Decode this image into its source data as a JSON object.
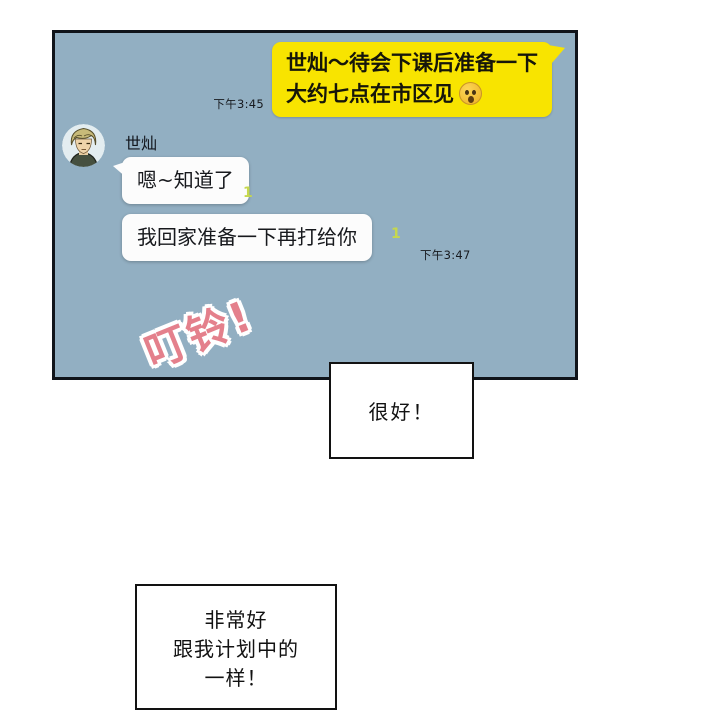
{
  "panel": {
    "outgoing_message": {
      "line1": "世灿～待会下课后准备一下",
      "line2": "大约七点在市区见",
      "emoji": "surprised-face",
      "time": "下午3:45"
    },
    "contact": {
      "name": "世灿"
    },
    "incoming_messages": [
      {
        "text": "嗯~知道了",
        "unread_count": "1"
      },
      {
        "text": "我回家准备一下再打给你",
        "unread_count": "1",
        "time": "下午3:47"
      }
    ]
  },
  "sound_effect": {
    "text": "叮铃!"
  },
  "narration_boxes": [
    {
      "text": "很好！"
    },
    {
      "line1": "非常好",
      "line2": "跟我计划中的",
      "line3": "一样！"
    }
  ],
  "colors": {
    "panel_background": "#92afc2",
    "panel_border": "#10141a",
    "outgoing_bubble": "#f8e400",
    "incoming_bubble": "#fcfcfc",
    "unread_count": "#c6d84d",
    "sound_effect_text": "#e4808c",
    "narration_border": "#121212"
  }
}
